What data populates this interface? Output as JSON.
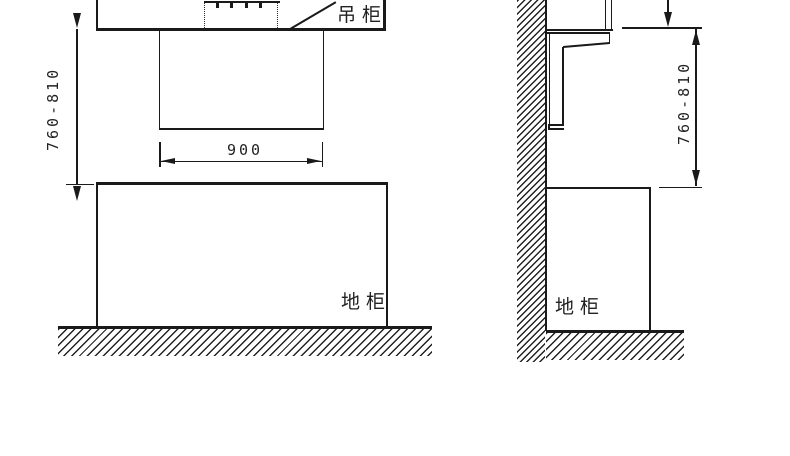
{
  "labels": {
    "front_view": {
      "hanging_cabinet": "吊柜",
      "base_cabinet": "地柜",
      "hood_width_dim": "900",
      "hood_height_dim": "760-810"
    },
    "side_view": {
      "base_cabinet": "地柜",
      "hood_height_dim": "760-810"
    }
  },
  "colors": {
    "line": "#1a1a1a",
    "background": "#ffffff"
  }
}
